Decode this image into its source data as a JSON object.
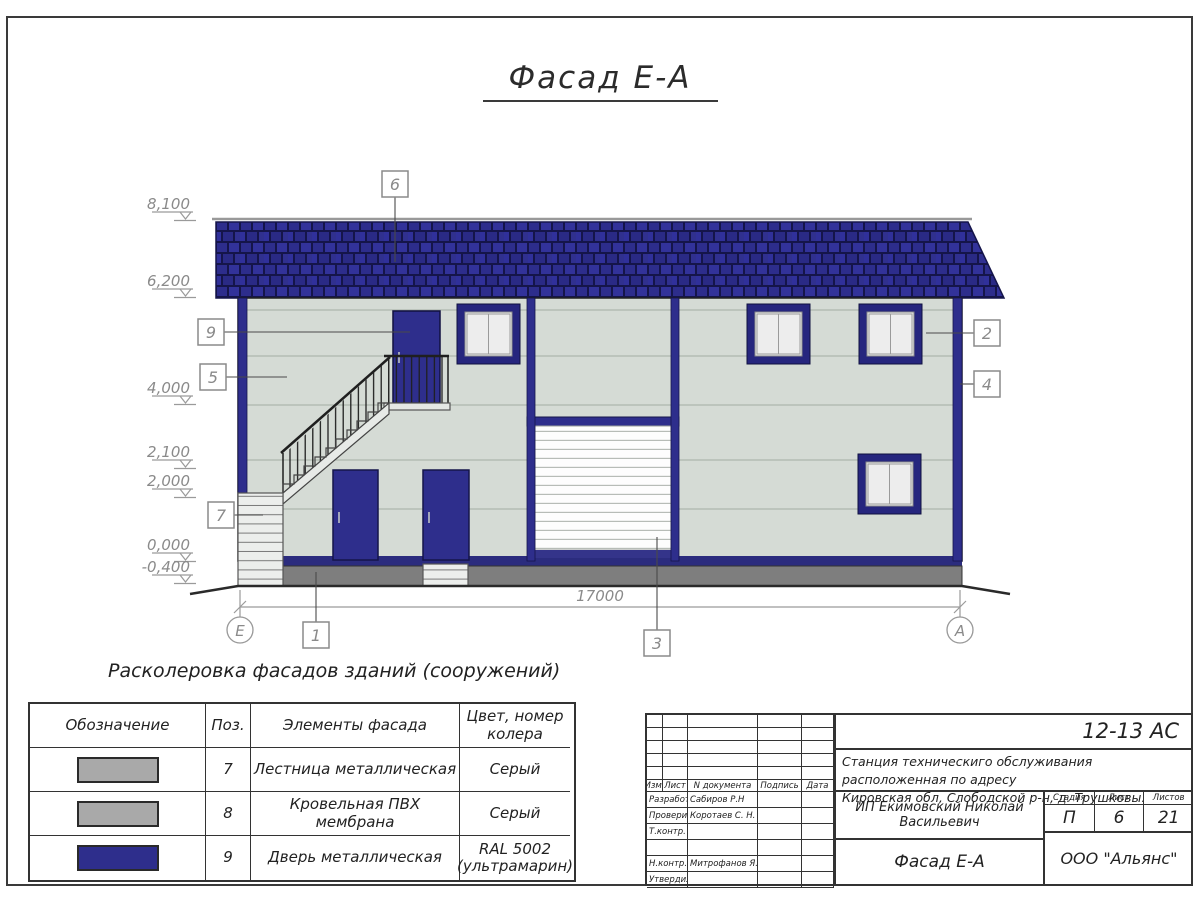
{
  "sheet": {
    "title": "Фасад Е-А",
    "legend_title": "Расколеровка фасадов зданий (сооружений)"
  },
  "drawing": {
    "span_dim": "17000",
    "axis_left": "Е",
    "axis_right": "А",
    "elevations": [
      {
        "label": "8,100"
      },
      {
        "label": "6,200"
      },
      {
        "label": "4,000"
      },
      {
        "label": "2,100"
      },
      {
        "label": "2,000"
      },
      {
        "label": "0,000"
      },
      {
        "label": "-0,400"
      }
    ],
    "callouts": {
      "roof": "6",
      "upper_door": "9",
      "wall": "5",
      "stair": "7",
      "window": "2",
      "corner": "4",
      "plinth": "1",
      "gate": "3"
    }
  },
  "legend": {
    "col_designation": "Обозначение",
    "col_pos": "Поз.",
    "col_element": "Элементы фасада",
    "col_color": "Цвет, номер колера",
    "rows": [
      {
        "pos": "7",
        "element": "Лестница металлическая",
        "color": "Серый",
        "swatch": "#a9a9a9"
      },
      {
        "pos": "8",
        "element": "Кровельная ПВХ мембрана",
        "color": "Серый",
        "swatch": "#a9a9a9"
      },
      {
        "pos": "9",
        "element": "Дверь металлическая",
        "color": "RAL 5002 (ультрамарин)",
        "swatch": "#2e2e8c"
      }
    ]
  },
  "titleblock": {
    "code": "12-13 АС",
    "project_line1": "Станция техническиго обслуживания расположенная по адресу",
    "project_line2": "Кировская обл, Слободской р-н, д. Трушковы.",
    "client": "ИП Екимовский Николай Васильевич",
    "drawing_name": "Фасад Е-А",
    "company": "ООО \"Альянс\"",
    "stage_label": "Стадия",
    "stage_value": "П",
    "sheet_label": "Лист",
    "sheet_value": "6",
    "sheets_label": "Листов",
    "sheets_value": "21",
    "head_izm": "Изм.",
    "head_list": "Лист",
    "head_doc": "N документа",
    "head_sign": "Подпись",
    "head_date": "Дата",
    "roles": [
      {
        "role": "Разработал",
        "name": "Сабиров Р.Н"
      },
      {
        "role": "Проверил",
        "name": "Коротаев С. Н."
      },
      {
        "role": "Т.контр.",
        "name": ""
      },
      {
        "role": "",
        "name": ""
      },
      {
        "role": "Н.контр.",
        "name": "Митрофанов Я. А."
      },
      {
        "role": "Утвердил",
        "name": ""
      }
    ]
  },
  "colors": {
    "facade_blue": "#2e2e8c",
    "roof_blue": "#28286e",
    "wall_panel": "#d5dbd5",
    "plinth_gray": "#7e7e7e"
  }
}
